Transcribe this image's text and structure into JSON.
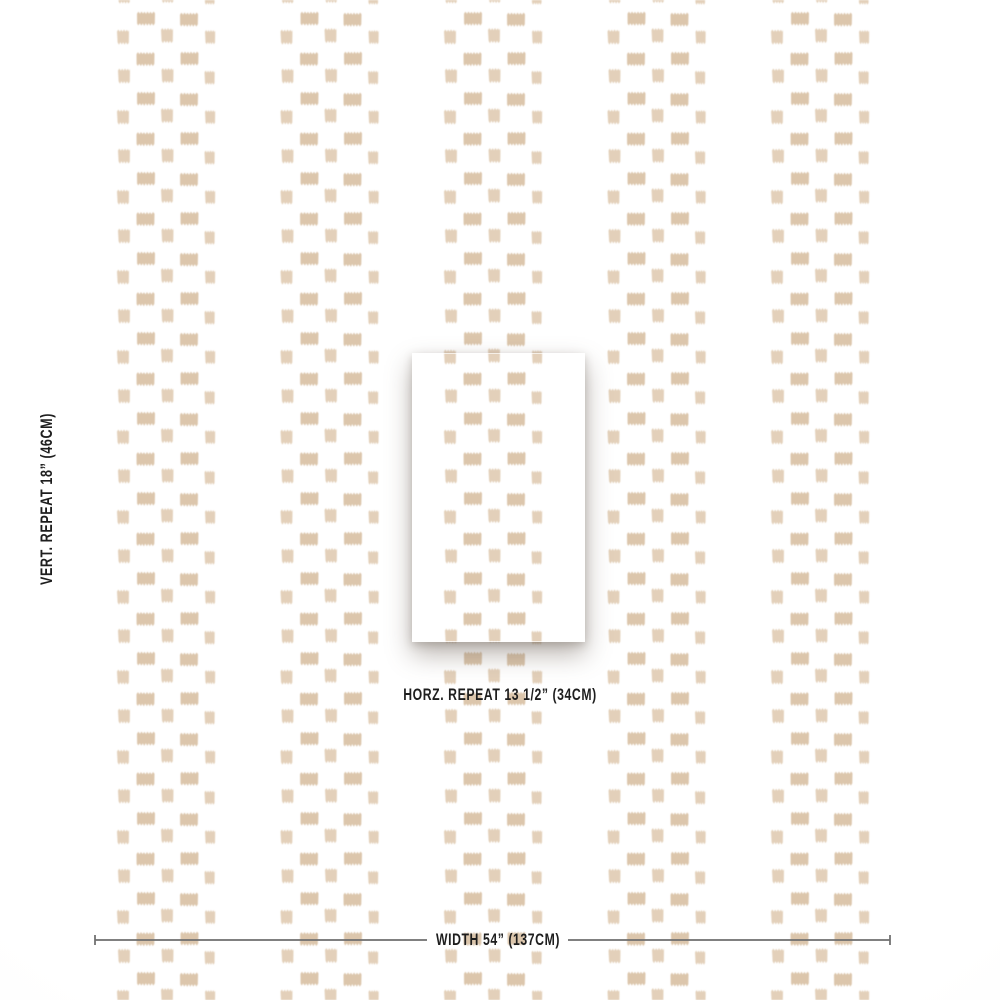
{
  "product_diagram": {
    "vertical_repeat_label": "VERT. REPEAT 18” (46CM)",
    "horizontal_repeat_label": "HORZ. REPEAT 13 1/2” (34CM)",
    "width_label": "WIDTH 54” (137CM)"
  },
  "colors": {
    "pattern_tan": "#dcc6ac",
    "pattern_tan_light": "#e3d0ba",
    "text": "#1e1e1e",
    "measure_line": "#6e6e6e",
    "background": "#ffffff"
  }
}
